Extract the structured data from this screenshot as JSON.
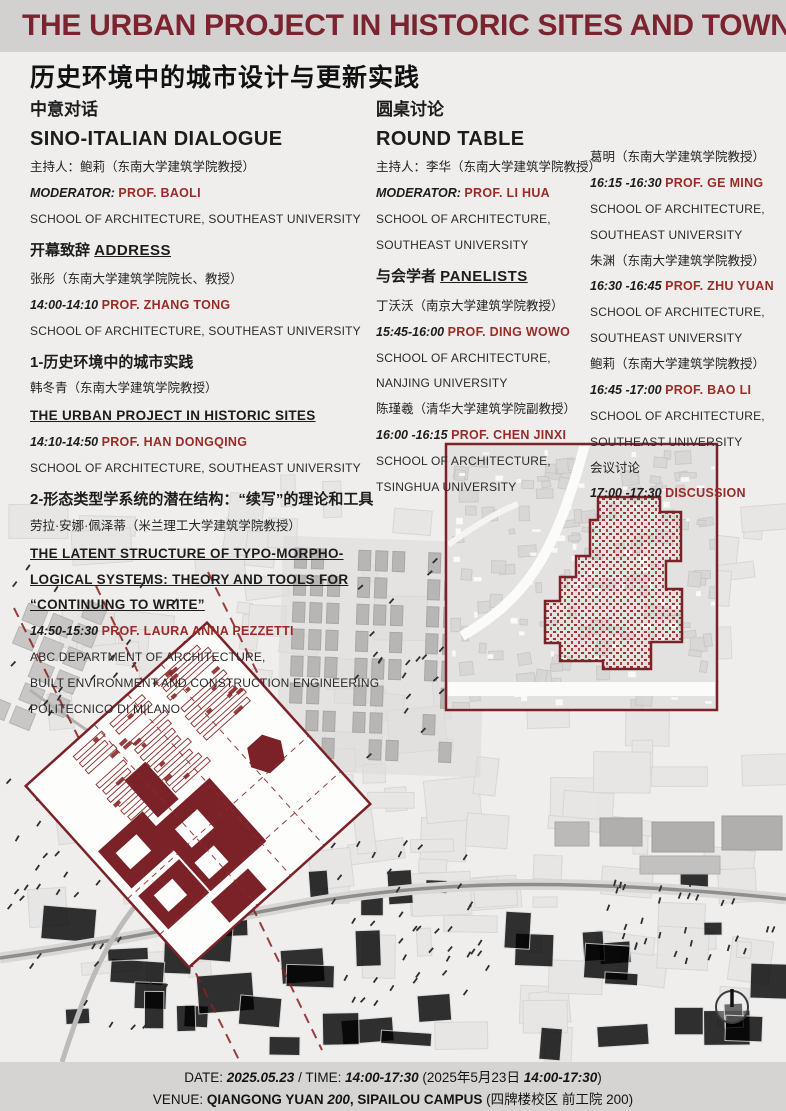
{
  "header": {
    "title": "THE URBAN PROJECT IN HISTORIC SITES AND TOWNS",
    "subtitle_cn": "历史环境中的城市设计与更新实践"
  },
  "colors": {
    "title_maroon": "#7b2430",
    "accent_red": "#9b2b26",
    "map_red": "#7b2228",
    "header_band": "#d2d1d0",
    "footer_band": "#d5d4d3",
    "page_bg": "#efeeec"
  },
  "columns": [
    {
      "id": "sino-italian-dialogue",
      "x": 30,
      "y": 100,
      "lines": [
        {
          "seg": [
            {
              "t": "中意对话",
              "c": "cnhead"
            }
          ]
        },
        {
          "seg": [
            {
              "t": "SINO-ITALIAN DIALOGUE",
              "c": "enhead"
            }
          ],
          "mt": 1
        },
        {
          "seg": [
            {
              "t": "主持人：鲍莉（东南大学建筑学院教授）",
              "c": "cn"
            }
          ],
          "mt": 5
        },
        {
          "seg": [
            {
              "t": "MODERATOR: ",
              "c": "time"
            },
            {
              "t": "PROF. BAOLI",
              "c": "red"
            }
          ]
        },
        {
          "seg": [
            {
              "t": "SCHOOL OF ARCHITECTURE, SOUTHEAST UNIVERSITY",
              "c": "affil"
            }
          ]
        },
        {
          "seg": [
            {
              "t": "开幕致辞 ",
              "c": "cnmid"
            },
            {
              "t": "ADDRESS",
              "c": "ulcn"
            }
          ],
          "mt": 13
        },
        {
          "seg": [
            {
              "t": "张彤（东南大学建筑学院院长、教授）",
              "c": "cn"
            }
          ],
          "mt": 9
        },
        {
          "seg": [
            {
              "t": "14:00-14:10  ",
              "c": "time"
            },
            {
              "t": "PROF. ZHANG TONG",
              "c": "red"
            }
          ]
        },
        {
          "seg": [
            {
              "t": "SCHOOL OF ARCHITECTURE, SOUTHEAST UNIVERSITY",
              "c": "affil"
            }
          ]
        },
        {
          "seg": [
            {
              "t": "1-历史环境中的城市实践",
              "c": "cnmid"
            }
          ],
          "mt": 13
        },
        {
          "seg": [
            {
              "t": "韩冬青（东南大学建筑学院教授）",
              "c": "cn"
            }
          ],
          "mt": 5
        },
        {
          "seg": [
            {
              "t": "THE URBAN PROJECT IN HISTORIC SITES",
              "c": "ul"
            }
          ],
          "mt": 9
        },
        {
          "seg": [
            {
              "t": "14:10-14:50  ",
              "c": "time"
            },
            {
              "t": "PROF. HAN DONGQING",
              "c": "red"
            }
          ]
        },
        {
          "seg": [
            {
              "t": "SCHOOL OF ARCHITECTURE, SOUTHEAST UNIVERSITY",
              "c": "affil"
            }
          ]
        },
        {
          "seg": [
            {
              "t": "2-形态类型学系统的潜在结构：“续写”的理论和工具",
              "c": "cnmid"
            }
          ],
          "mt": 13
        },
        {
          "seg": [
            {
              "t": "劳拉·安娜·佩泽蒂（米兰理工大学建筑学院教授）",
              "c": "cn"
            }
          ],
          "mt": 3
        },
        {
          "seg": [
            {
              "t": "THE LATENT STRUCTURE OF TYPO-MORPHO-",
              "c": "ul"
            }
          ],
          "mt": 9
        },
        {
          "seg": [
            {
              "t": "LOGICAL SYSTEMS: THEORY AND TOOLS FOR",
              "c": "ul"
            }
          ]
        },
        {
          "seg": [
            {
              "t": "“CONTINUING TO WRITE”",
              "c": "ul"
            }
          ]
        },
        {
          "seg": [
            {
              "t": "14:50-15:30  ",
              "c": "time"
            },
            {
              "t": "PROF. LAURA ANNA PEZZETTI",
              "c": "red"
            }
          ]
        },
        {
          "seg": [
            {
              "t": "ABC DEPARTMENT OF ARCHITECTURE,",
              "c": "affil"
            }
          ]
        },
        {
          "seg": [
            {
              "t": "BUILT ENVIRONMENT AND CONSTRUCTION ENGINEERING",
              "c": "affil"
            }
          ]
        },
        {
          "seg": [
            {
              "t": "POLITECNICO DI MILANO",
              "c": "affil"
            }
          ]
        }
      ]
    },
    {
      "id": "round-table",
      "x": 376,
      "y": 100,
      "lines": [
        {
          "seg": [
            {
              "t": "圆桌讨论",
              "c": "cnhead"
            }
          ]
        },
        {
          "seg": [
            {
              "t": "ROUND TABLE",
              "c": "enhead"
            }
          ],
          "mt": 1
        },
        {
          "seg": [
            {
              "t": "主持人：李华（东南大学建筑学院教授）",
              "c": "cn"
            }
          ],
          "mt": 5
        },
        {
          "seg": [
            {
              "t": "MODERATOR:  ",
              "c": "time"
            },
            {
              "t": "PROF. LI HUA",
              "c": "red"
            }
          ]
        },
        {
          "seg": [
            {
              "t": "SCHOOL OF ARCHITECTURE,",
              "c": "affil"
            }
          ]
        },
        {
          "seg": [
            {
              "t": "SOUTHEAST UNIVERSITY",
              "c": "affil"
            }
          ]
        },
        {
          "seg": [
            {
              "t": "与会学者 ",
              "c": "cnmid"
            },
            {
              "t": "PANELISTS",
              "c": "ulcn"
            }
          ],
          "mt": 13
        },
        {
          "seg": [
            {
              "t": "丁沃沃（南京大学建筑学院教授）",
              "c": "cn"
            }
          ],
          "mt": 10
        },
        {
          "seg": [
            {
              "t": "15:45-16:00  ",
              "c": "time"
            },
            {
              "t": "PROF. DING WOWO",
              "c": "red"
            }
          ]
        },
        {
          "seg": [
            {
              "t": "SCHOOL OF ARCHITECTURE,",
              "c": "affil"
            }
          ]
        },
        {
          "seg": [
            {
              "t": "NANJING UNIVERSITY",
              "c": "affil"
            }
          ]
        },
        {
          "seg": [
            {
              "t": "陈瑾羲（清华大学建筑学院副教授）",
              "c": "cn"
            }
          ],
          "mt": 4
        },
        {
          "seg": [
            {
              "t": "16:00 -16:15  ",
              "c": "time"
            },
            {
              "t": "PROF. CHEN JINXI",
              "c": "red"
            }
          ]
        },
        {
          "seg": [
            {
              "t": "SCHOOL OF ARCHITECTURE,",
              "c": "affil"
            }
          ]
        },
        {
          "seg": [
            {
              "t": "TSINGHUA UNIVERSITY",
              "c": "affil"
            }
          ]
        }
      ]
    },
    {
      "id": "round-table-continued",
      "x": 590,
      "y": 148,
      "lines": [
        {
          "seg": [
            {
              "t": "葛明（东南大学建筑学院教授）",
              "c": "cn"
            }
          ]
        },
        {
          "seg": [
            {
              "t": "16:15 -16:30  ",
              "c": "time"
            },
            {
              "t": "PROF. GE MING",
              "c": "red"
            }
          ]
        },
        {
          "seg": [
            {
              "t": "SCHOOL OF ARCHITECTURE,",
              "c": "affil"
            }
          ]
        },
        {
          "seg": [
            {
              "t": "SOUTHEAST UNIVERSITY",
              "c": "affil"
            }
          ]
        },
        {
          "seg": [
            {
              "t": "朱渊（东南大学建筑学院教授）",
              "c": "cn"
            }
          ],
          "mt": 3
        },
        {
          "seg": [
            {
              "t": "16:30 -16:45  ",
              "c": "time"
            },
            {
              "t": "PROF. ZHU YUAN",
              "c": "red"
            }
          ]
        },
        {
          "seg": [
            {
              "t": "SCHOOL OF ARCHITECTURE,",
              "c": "affil"
            }
          ]
        },
        {
          "seg": [
            {
              "t": "SOUTHEAST UNIVERSITY",
              "c": "affil"
            }
          ]
        },
        {
          "seg": [
            {
              "t": "鲍莉（东南大学建筑学院教授）",
              "c": "cn"
            }
          ],
          "mt": 3
        },
        {
          "seg": [
            {
              "t": "16:45 -17:00  ",
              "c": "time"
            },
            {
              "t": "PROF. BAO LI",
              "c": "red"
            }
          ]
        },
        {
          "seg": [
            {
              "t": "SCHOOL OF ARCHITECTURE,",
              "c": "affil"
            }
          ]
        },
        {
          "seg": [
            {
              "t": "SOUTHEAST UNIVERSITY",
              "c": "affil"
            }
          ]
        },
        {
          "seg": [
            {
              "t": "会议讨论",
              "c": "cn"
            }
          ],
          "mt": 3
        },
        {
          "seg": [
            {
              "t": "17:00 -17:30  ",
              "c": "time"
            },
            {
              "t": "DISCUSSION",
              "c": "red"
            }
          ]
        }
      ]
    }
  ],
  "footer": {
    "line1": [
      {
        "t": "DATE:  ",
        "c": "plain"
      },
      {
        "t": "2025.05.23",
        "c": "bi"
      },
      {
        "t": " / TIME:  ",
        "c": "plain"
      },
      {
        "t": "14:00-17:30",
        "c": "bi"
      },
      {
        "t": "  (2025年5月23日 ",
        "c": "plain"
      },
      {
        "t": "14:00-17:30",
        "c": "bi"
      },
      {
        "t": ")",
        "c": "plain"
      }
    ],
    "line2": [
      {
        "t": "VENUE: ",
        "c": "plain"
      },
      {
        "t": "QIANGONG YUAN ",
        "c": "b"
      },
      {
        "t": "200",
        "c": "bi"
      },
      {
        "t": ", SIPAILOU CAMPUS ",
        "c": "b"
      },
      {
        "t": "(四牌楼校区  前工院 200)",
        "c": "plain"
      }
    ]
  },
  "map": {
    "north_arrow_icon": "north-arrow-icon",
    "left_map_name": "campus-site-plan-map",
    "right_map_name": "historic-block-map"
  }
}
